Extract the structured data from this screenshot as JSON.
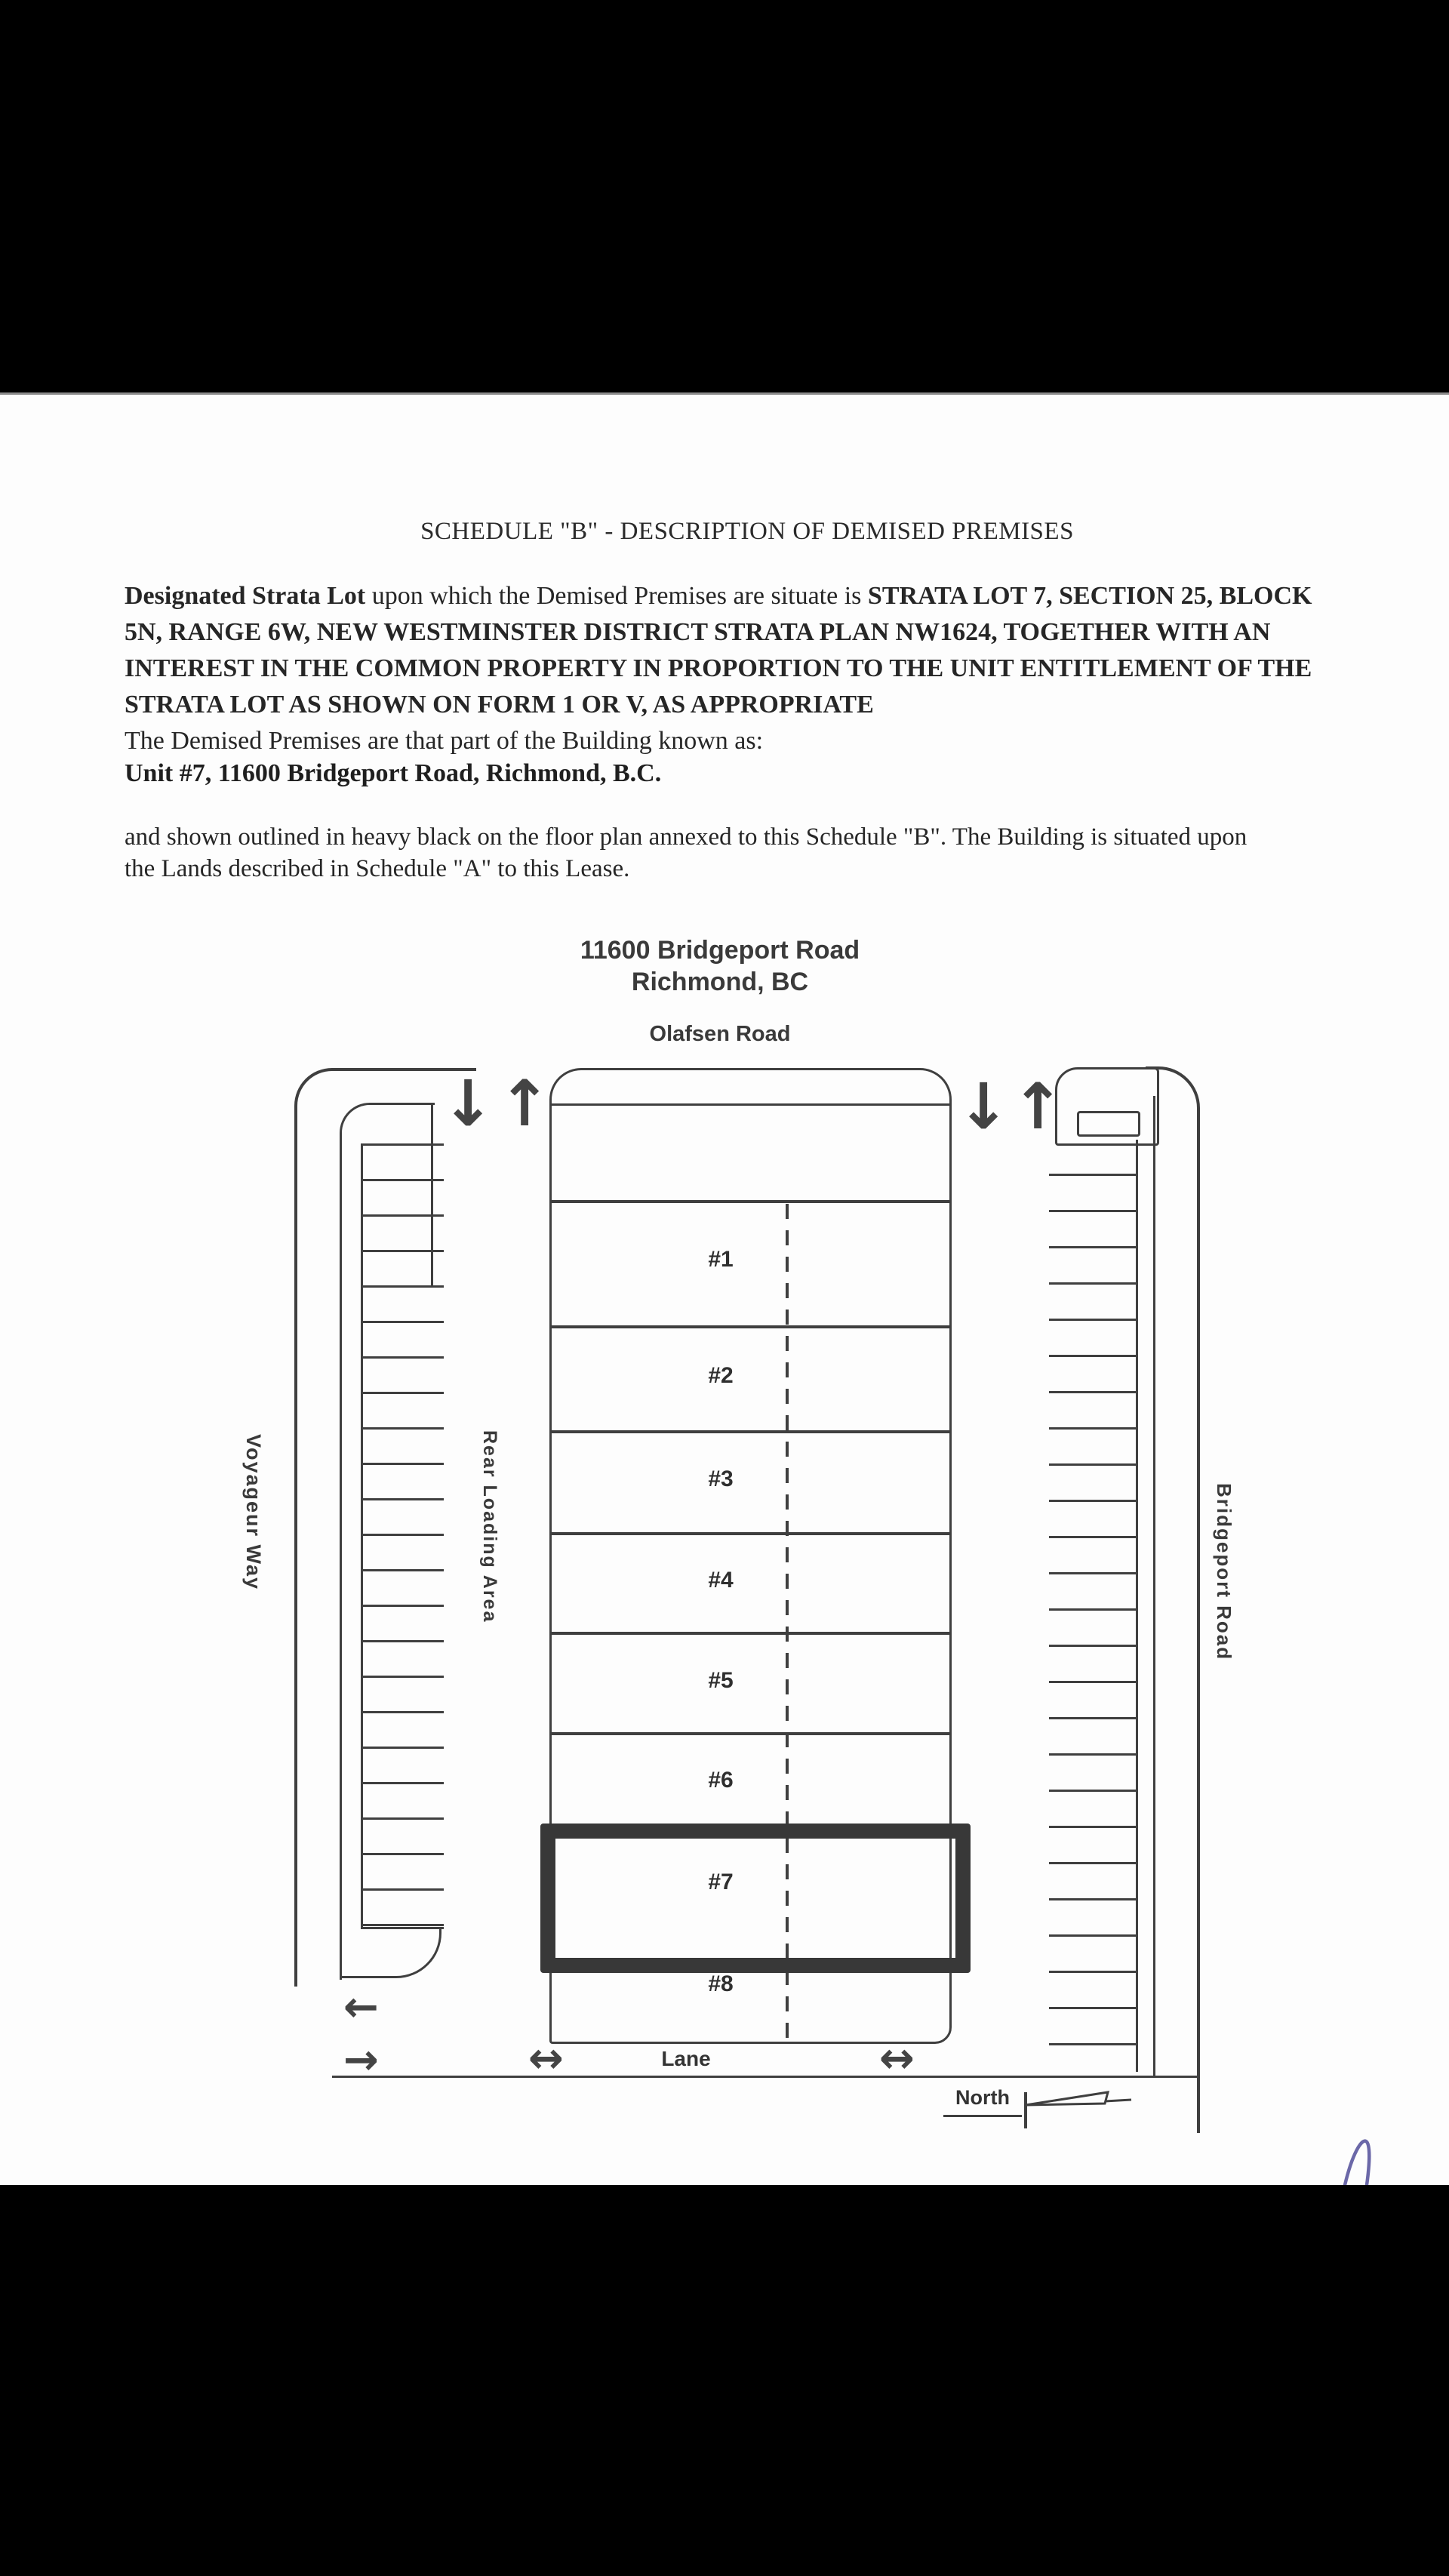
{
  "document": {
    "title": "SCHEDULE \"B\" - DESCRIPTION OF DEMISED PREMISES",
    "para1": {
      "line1_bold": "Designated Strata Lot",
      "line1_regular": " upon which the Demised Premises are situate is ",
      "line1_bold2": "STRATA LOT 7, SECTION 25, BLOCK",
      "line2": "5N, RANGE 6W, NEW WESTMINSTER DISTRICT STRATA PLAN NW1624, TOGETHER WITH AN",
      "line3": "INTEREST IN THE COMMON PROPERTY IN PROPORTION TO THE UNIT ENTITLEMENT OF THE",
      "line4": "STRATA LOT AS SHOWN ON FORM 1 OR V, AS APPROPRIATE",
      "line5": "The Demised Premises are that part of the Building known as:"
    },
    "unit_line": "Unit #7, 11600 Bridgeport Road, Richmond,  B.C.",
    "para2_line1": "and shown outlined in heavy black on the floor plan annexed to this Schedule \"B\".  The Building is situated upon",
    "para2_line2": "the Lands described in Schedule \"A\" to this Lease."
  },
  "plan": {
    "header_line1": "11600 Bridgeport Road",
    "header_line2": "Richmond, BC",
    "road_top": "Olafsen Road",
    "road_left": "Voyageur Way",
    "area_center": "Rear Loading Area",
    "road_right": "Bridgeport Road",
    "road_bottom": "Lane",
    "north_label": "North",
    "units": [
      "#1",
      "#2",
      "#3",
      "#4",
      "#5",
      "#6",
      "#7",
      "#8"
    ],
    "highlighted_unit": "#7",
    "icons": {
      "arrow_down": "↓",
      "arrow_up": "↑",
      "arrow_left": "←",
      "arrow_right": "→",
      "arrow_leftright": "↔"
    }
  },
  "colors": {
    "ink": "#3f3f3f",
    "highlight_outline": "#383838",
    "pen_mark": "#6b68a8",
    "letterbox": "#000000"
  }
}
